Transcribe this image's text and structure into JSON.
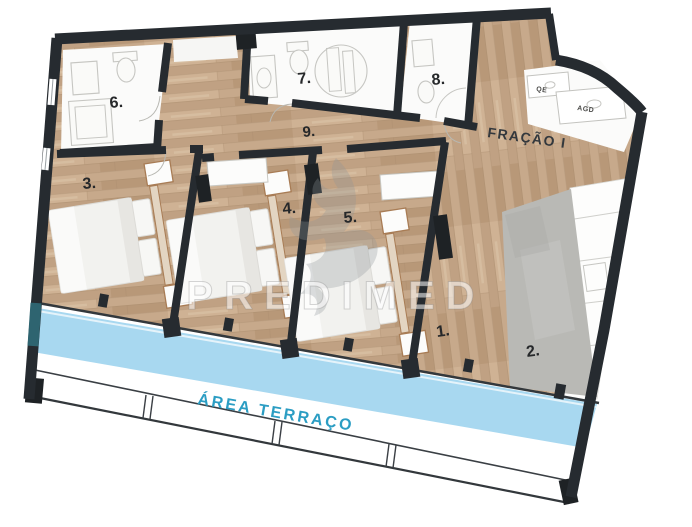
{
  "plan": {
    "fraction_label": "FRAÇÃO I",
    "terrace_label": "ÁREA TERRAÇO",
    "watermark": "PREDIMED",
    "room_labels": {
      "r1": "1.",
      "r2": "2.",
      "r3": "3.",
      "r4": "4.",
      "r5": "5.",
      "r6": "6.",
      "r7": "7.",
      "r8": "8.",
      "r9": "9."
    },
    "utility_labels": {
      "electrical": "QE",
      "water": "AGD"
    },
    "colors": {
      "wall": "#262b30",
      "wood_floor": "#c7a98b",
      "bathroom_floor": "#fbfbfa",
      "kitchen_floor": "#b9b9b5",
      "terrace_band": "#a8d8f0",
      "terrace_label_text": "#2b9dc3",
      "accent_teal": "#2e6470",
      "room_label_text": "#26282a"
    }
  }
}
